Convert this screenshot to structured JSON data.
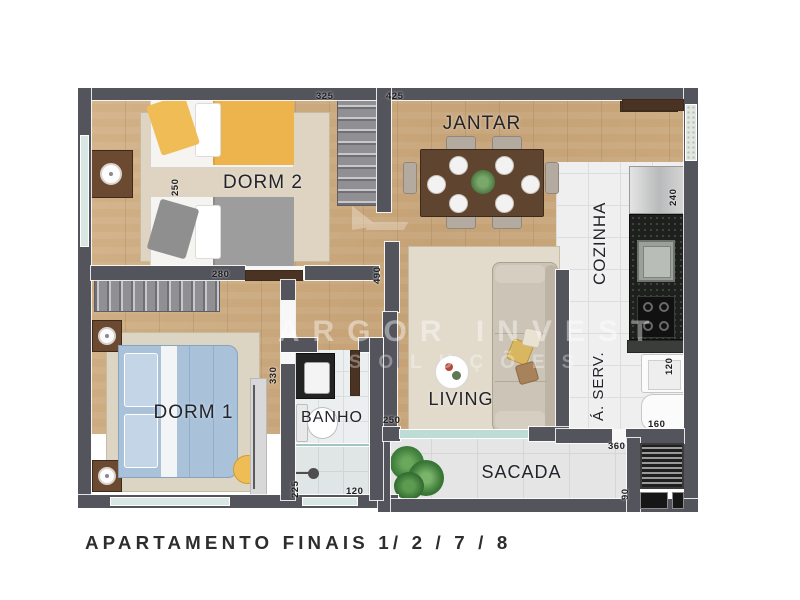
{
  "caption": "APARTAMENTO FINAIS 1/ 2 / 7 / 8",
  "watermark": {
    "brand": "ARGOR INVEST",
    "tagline": "SOLUÇÕES"
  },
  "rooms": {
    "dorm2": {
      "label": "DORM 2"
    },
    "jantar": {
      "label": "JANTAR"
    },
    "cozinha": {
      "label": "COZINHA"
    },
    "dorm1": {
      "label": "DORM 1"
    },
    "banho": {
      "label": "BANHO"
    },
    "living": {
      "label": "LIVING"
    },
    "aserv": {
      "label": "Á. SERV."
    },
    "sacada": {
      "label": "SACADA"
    }
  },
  "dimensions_cm": {
    "dorm2_width": "325",
    "jantar_width": "425",
    "dorm2_depth": "250",
    "dorm1_width": "280",
    "social_depth": "490",
    "dorm1_depth": "330",
    "banho_depth": "225",
    "banho_width": "120",
    "living_opening": "250",
    "cozinha_depth": "240",
    "tanque_width": "120",
    "aserv_width": "160",
    "sacada_width": "360",
    "sacada_depth": "90"
  },
  "colors": {
    "wall": "#54555c",
    "wood_floor": "#c9a87d",
    "tile_floor": "#efefef",
    "bed_yellow": "#edb44e",
    "bed_gray": "#9d9d9d",
    "bed_blue": "#a9c2da",
    "sofa": "#cdc5b8",
    "granite": "#1d201d",
    "plant": "#41803d",
    "glass": "#bedcd6"
  }
}
